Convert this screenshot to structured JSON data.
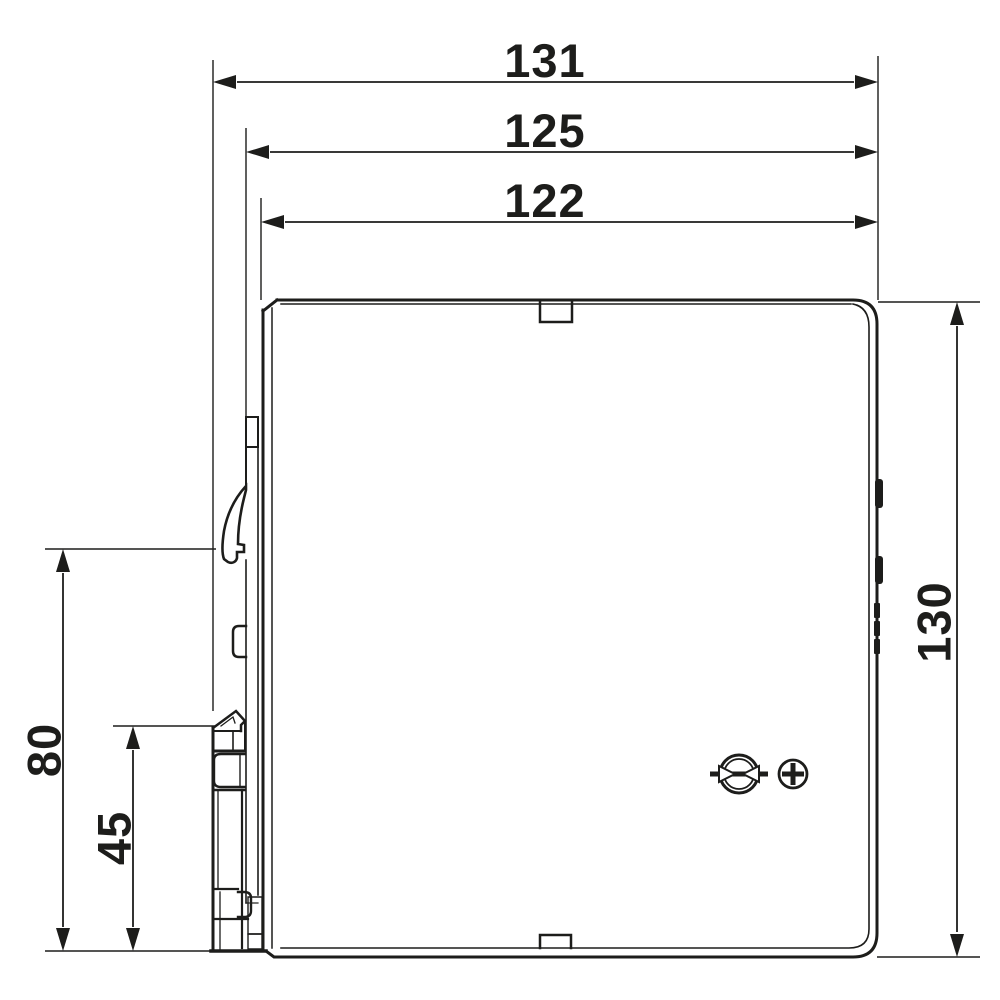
{
  "drawing": {
    "type": "technical-dimension-drawing",
    "subject": "din-rail-power-supply-side-view",
    "colors": {
      "line": "#1d1d1b",
      "background": "#ffffff"
    },
    "dimensions": {
      "top": [
        {
          "label": "131"
        },
        {
          "label": "125"
        },
        {
          "label": "122"
        }
      ],
      "right": [
        {
          "label": "130"
        }
      ],
      "left": [
        {
          "label": "80"
        },
        {
          "label": "45"
        }
      ]
    },
    "icons": [
      "potentiometer-adjust-icon",
      "plus-circle-icon"
    ]
  }
}
